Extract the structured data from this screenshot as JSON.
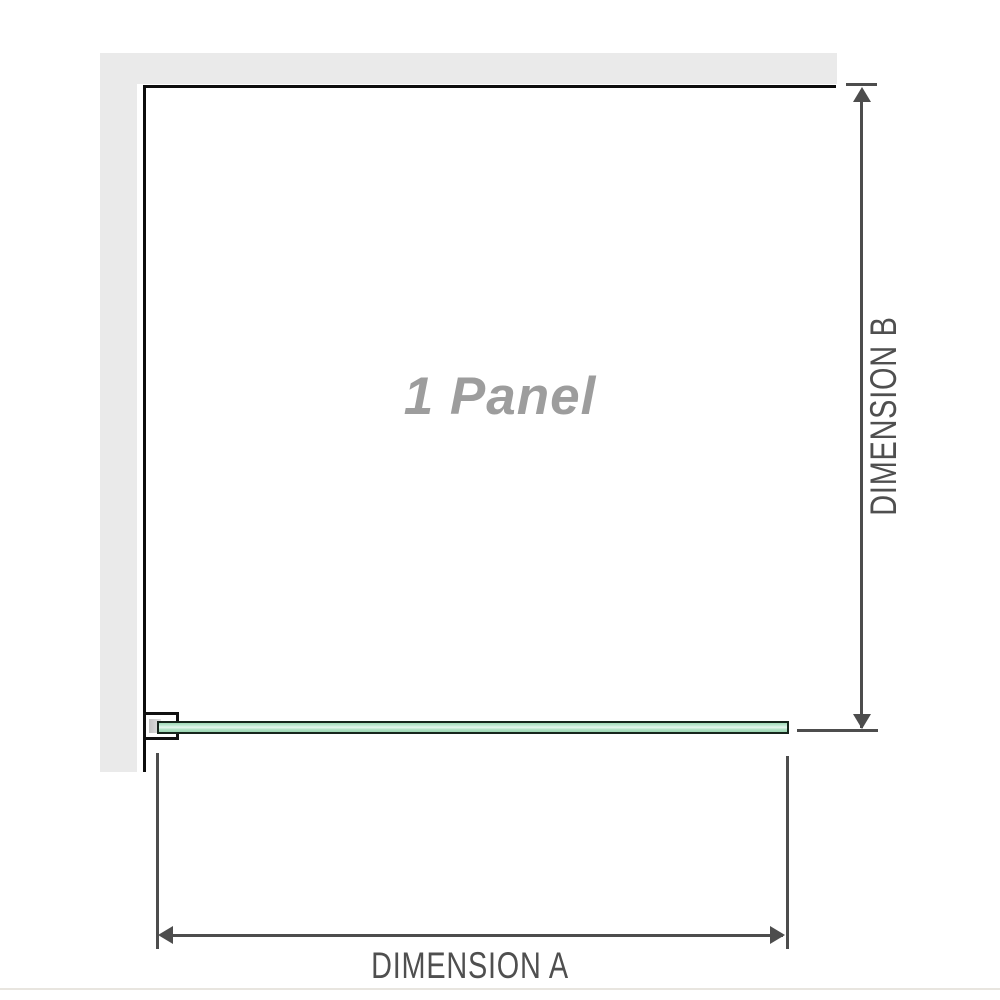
{
  "diagram": {
    "panel_label": "1 Panel",
    "dimension_a": {
      "label": "DIMENSION A",
      "orientation": "horizontal"
    },
    "dimension_b": {
      "label": "DIMENSION B",
      "orientation": "vertical"
    },
    "colors": {
      "wall": "#eaeaea",
      "panel_edge": "#0d0d0d",
      "dimension_line": "#4d4d4d",
      "dimension_text": "#4f4f4f",
      "panel_label_text": "#9d9d9d",
      "glass_fill_light": "#e7f8ef",
      "glass_fill_mid": "#b0e1c4",
      "glass_border": "#16261c",
      "bracket_border": "#111111",
      "bracket_pad": "#c3c3c3",
      "divider": "#e8e5df"
    }
  }
}
